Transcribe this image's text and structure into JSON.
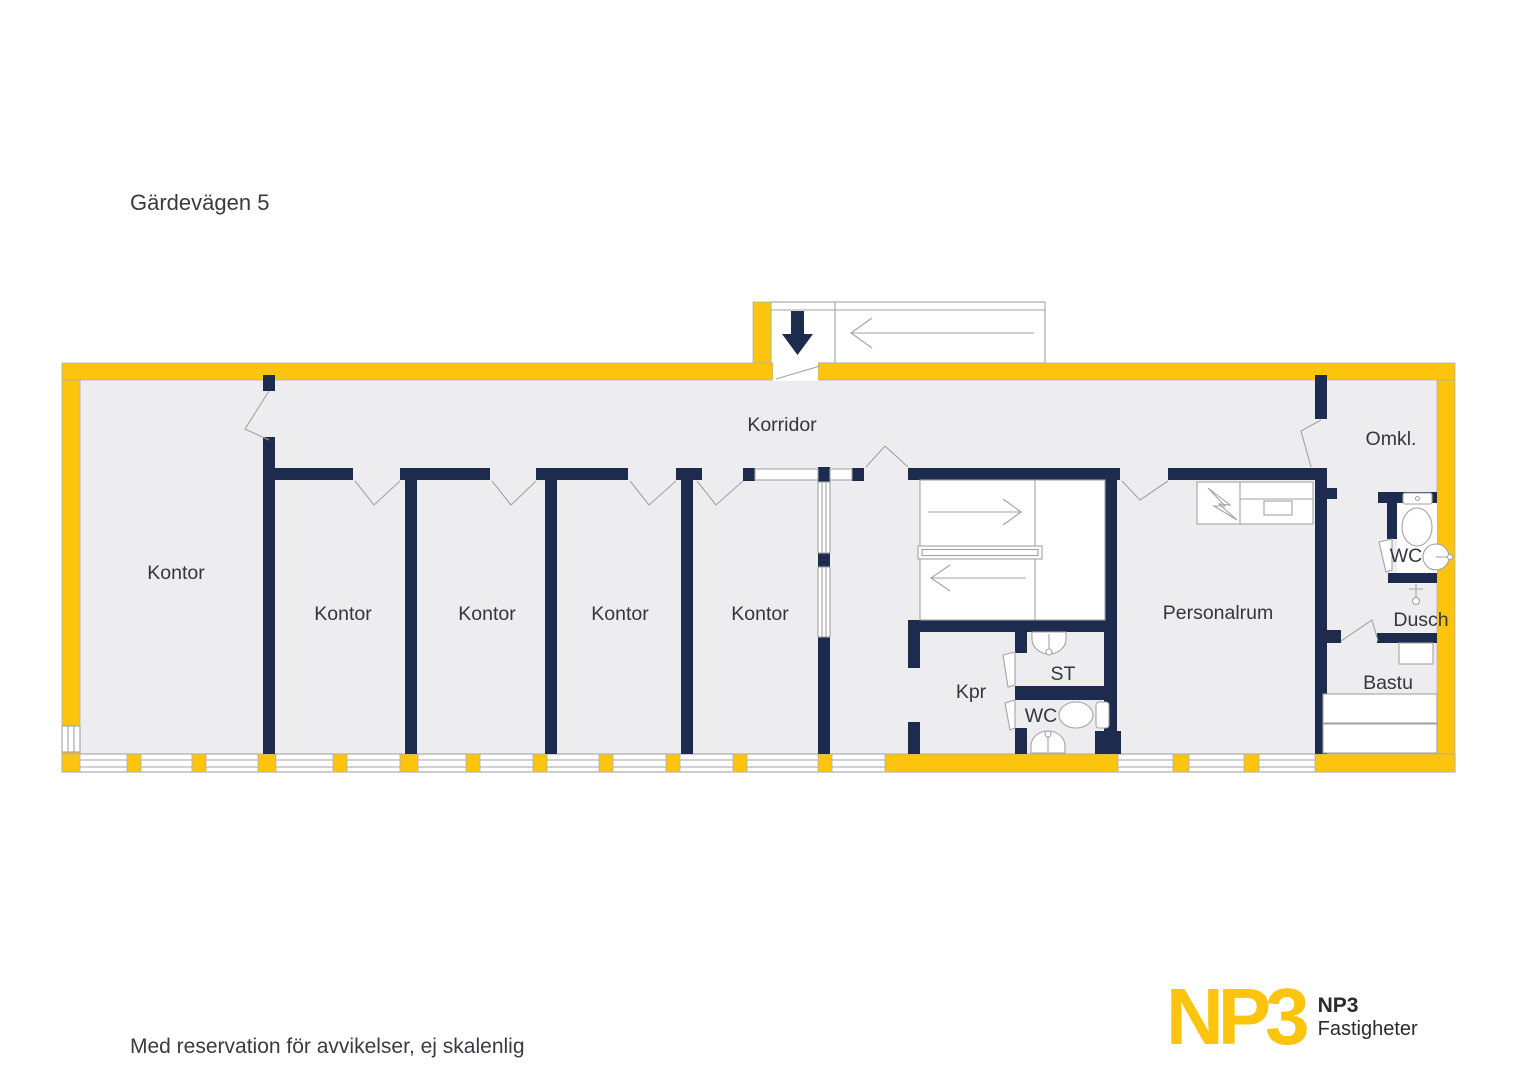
{
  "title": "Gärdevägen 5",
  "footer": {
    "disclaimer": "Med reservation för avvikelser, ej skalenlig"
  },
  "rooms": {
    "korridor": "Korridor",
    "kontor": "Kontor",
    "personalrum": "Personalrum",
    "omkl": "Omkl.",
    "wc": "WC",
    "dusch": "Dusch",
    "bastu": "Bastu",
    "st": "ST",
    "kpr": "Kpr"
  },
  "logo": {
    "mark": "NP3",
    "name": "NP3",
    "name2": "Fastigheter"
  },
  "colors": {
    "wall_outer_yellow": "#fcc40d",
    "wall_inner_navy": "#1c2b4e",
    "floor_gray": "#ededef",
    "line_gray": "#a3a3a3",
    "text_dark": "#35363c"
  }
}
